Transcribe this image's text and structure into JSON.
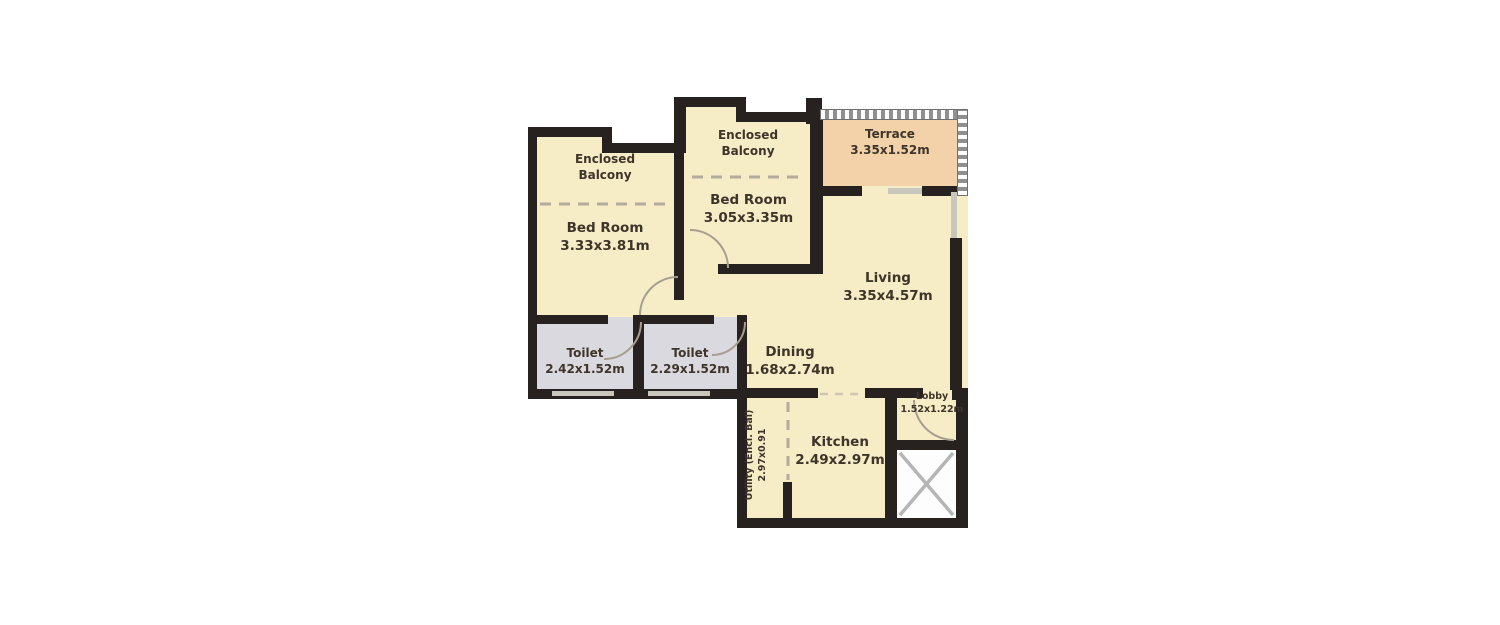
{
  "rooms": {
    "balcony1": {
      "name": "Enclosed Balcony",
      "dims": ""
    },
    "bedroom1": {
      "name": "Bed Room",
      "dims": "3.33x3.81m"
    },
    "balcony2": {
      "name": "Enclosed Balcony",
      "dims": ""
    },
    "bedroom2": {
      "name": "Bed Room",
      "dims": "3.05x3.35m"
    },
    "terrace": {
      "name": "Terrace",
      "dims": "3.35x1.52m"
    },
    "living": {
      "name": "Living",
      "dims": "3.35x4.57m"
    },
    "toilet1": {
      "name": "Toilet",
      "dims": "2.42x1.52m"
    },
    "toilet2": {
      "name": "Toilet",
      "dims": "2.29x1.52m"
    },
    "dining": {
      "name": "Dining",
      "dims": "1.68x2.74m"
    },
    "kitchen": {
      "name": "Kitchen",
      "dims": "2.49x2.97m"
    },
    "lobby": {
      "name": "Lobby",
      "dims": "1.52x1.22m"
    },
    "utility": {
      "name": "Utility (Encl. Bal)",
      "dims": "2.97x0.91"
    }
  },
  "colors": {
    "room_fill": "#f6ecc6",
    "terrace_fill": "#f3d2aa",
    "toilet_fill": "#dbd9e0",
    "wall": "#272120",
    "text": "#3e352a",
    "background": "#ffffff"
  }
}
